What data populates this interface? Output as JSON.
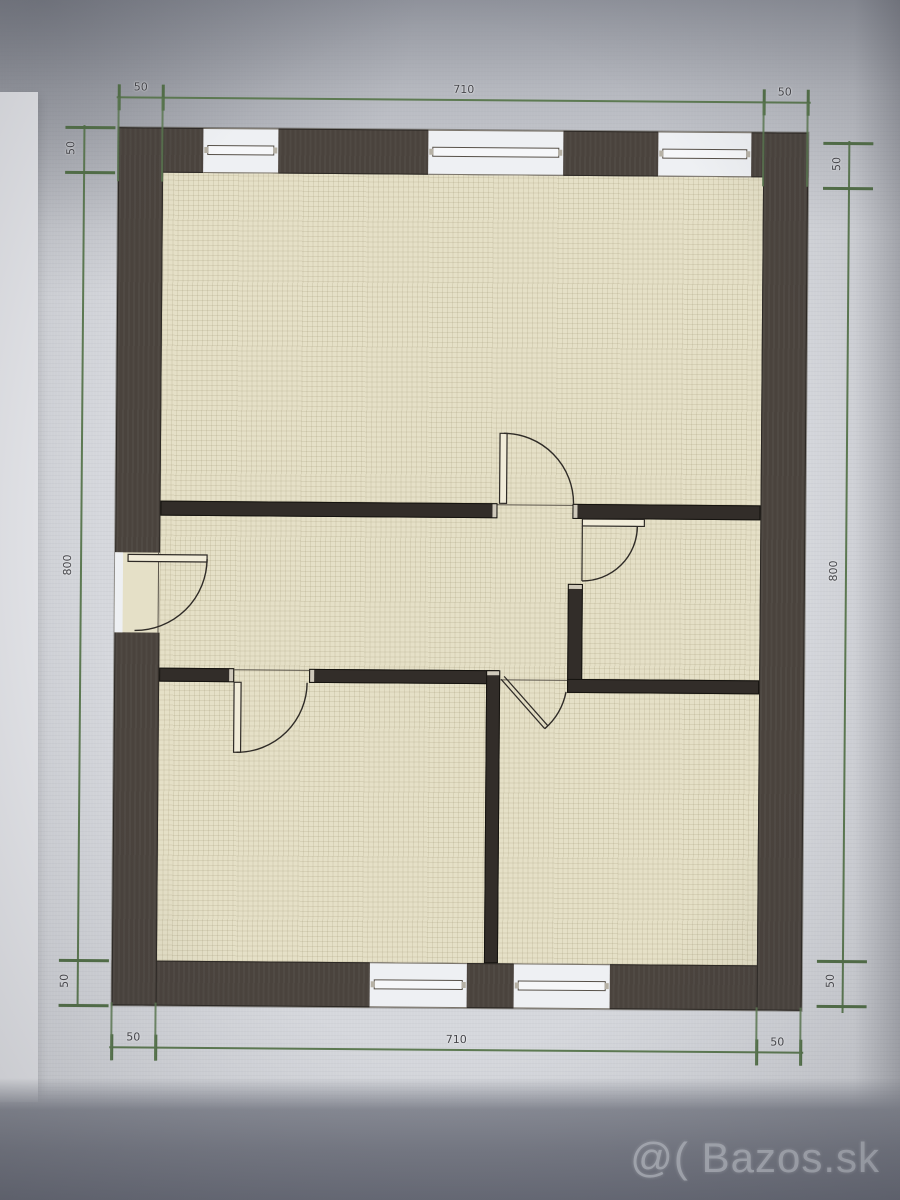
{
  "title": "floor-plan-photo",
  "watermark": {
    "text": "@( Bazos.sk"
  },
  "dims": {
    "top": [
      "50",
      "710",
      "50"
    ],
    "bottom": [
      "50",
      "710",
      "50"
    ],
    "left": [
      "50",
      "800",
      "50"
    ],
    "right": [
      "50",
      "800",
      "50"
    ]
  },
  "colors": {
    "background_grey": "#d5d7dc",
    "bottom_band_grey": "#6f727d",
    "outer_wall": "#4a433d",
    "interior_wall": "#322d29",
    "floor_beige": "#e5e0c7",
    "window_gap": "#eef0f3",
    "dimension_green": "#5d7a52",
    "dim_label_grey": "#45454a",
    "watermark_grey": "#ced1d9"
  },
  "plan_features": {
    "top_windows": 3,
    "bottom_windows": 2,
    "interior_doors": 4,
    "entrance_doors": 1
  }
}
